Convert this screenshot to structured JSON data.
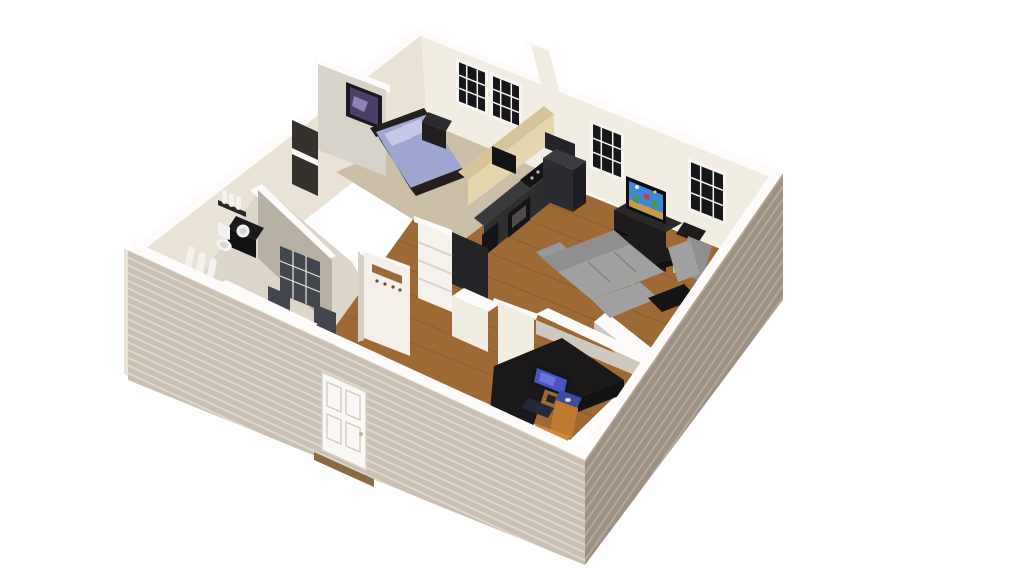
{
  "scene": {
    "type": "3d-floor-plan-render",
    "view": "isometric-birds-eye",
    "description": "3D dollhouse cutaway render of a one-bedroom apartment",
    "background": "#ffffff"
  },
  "colors": {
    "background": "#ffffff",
    "wall_top": "#fdfcfa",
    "wall_cream": "#f2ede3",
    "wall_cream_dark": "#e9e2d7",
    "wall_gray_lit": "#d8d3ca",
    "wall_gray": "#b7b0a4",
    "wall_gray_soft": "#cfc8be",
    "siding_light": "#c9c0b3",
    "siding_light_stripe": "#ded7cb",
    "siding_dark": "#9d9183",
    "siding_dark_stripe": "#b3a89a",
    "wood_floor": "#9d6a36",
    "wood_streak": "#7e4f24",
    "carpet": "#cbbfa7",
    "tile": "#dbd5ca",
    "closet_dark": "#35322e",
    "counter_dark": "#3a393c",
    "counter_face": "#2e2d30",
    "appliance_black": "#141316",
    "appliance_gray": "#2c2c30",
    "bar_top": "#d8c49a",
    "bar_face": "#e6d6ae",
    "bedding": "#9fa6d0",
    "pillow": "#c5c9e6",
    "bed_frame": "#241f1c",
    "sofa": "#a0a0a0",
    "sofa_dark": "#8f8f8f",
    "table_black": "#1d1b1c",
    "chair_orange": "#d2863a",
    "chair_orange_dark": "#c07a30",
    "monitor_blue": "#4a55c4",
    "monitor_blue_light": "#6a74d8",
    "mousepad_blue": "#3b4ba6",
    "keyboard_dark": "#23283a",
    "door_white": "#f9f8f5",
    "door_trim": "#cfc9be",
    "door_dark": "#43464c",
    "glass_dark": "#17171a",
    "window_frame": "#f7f5f1",
    "hook_brown": "#9a6a3c",
    "hook_peg": "#704a28",
    "threshold_brown": "#8a6a44",
    "white_fixture": "#f4f3f0",
    "fixture_shadow": "#d8d6d0",
    "tv_sky": "#3f86d8",
    "tv_ground": "#c89a4a",
    "tv_green": "#3f9e3f",
    "tv_red": "#d33a2a",
    "tv_yellow": "#f4d44a",
    "art_purple": "#4a4066",
    "art_purple_light": "#8d81b8",
    "frame_black": "#1c1822",
    "leg_silver": "#dcdcdc"
  },
  "inventory": {
    "rooms": [
      {
        "name": "bedroom",
        "floor": "carpet",
        "items": [
          "double-bed",
          "pillows",
          "headboard",
          "nightstand",
          "wall-art-picture",
          "closet-shelf",
          "double-window"
        ]
      },
      {
        "name": "kitchen",
        "floor": "wood",
        "items": [
          "breakfast-bar",
          "dark-counters",
          "cooktop",
          "oven",
          "dishwasher",
          "microwave",
          "refrigerator",
          "pantry-shelves",
          "end-cabinet"
        ]
      },
      {
        "name": "living-room",
        "floor": "wood",
        "items": [
          "tv",
          "tv-console",
          "coffee-table",
          "sectional-sofa",
          "loveseat",
          "end-table",
          "console-table",
          "window",
          "window"
        ]
      },
      {
        "name": "bathroom",
        "floor": "tile",
        "items": [
          "toilet",
          "vanity-sink",
          "toiletry-bottles",
          "shower-towels",
          "towel-bar"
        ]
      },
      {
        "name": "hallway",
        "floor": "wood-and-tile",
        "items": [
          "coat-hook-rack",
          "glass-panel-door",
          "interior-door",
          "interior-door",
          "front-door"
        ]
      },
      {
        "name": "office",
        "floor": "wood",
        "items": [
          "l-shaped-desk",
          "monitor",
          "keyboard",
          "mouse-pad",
          "office-chair"
        ]
      }
    ],
    "exterior": {
      "siding": "horizontal-lap-siding",
      "windows_total": 4,
      "window_panes": "3x3",
      "front_door": "white-paneled"
    }
  }
}
